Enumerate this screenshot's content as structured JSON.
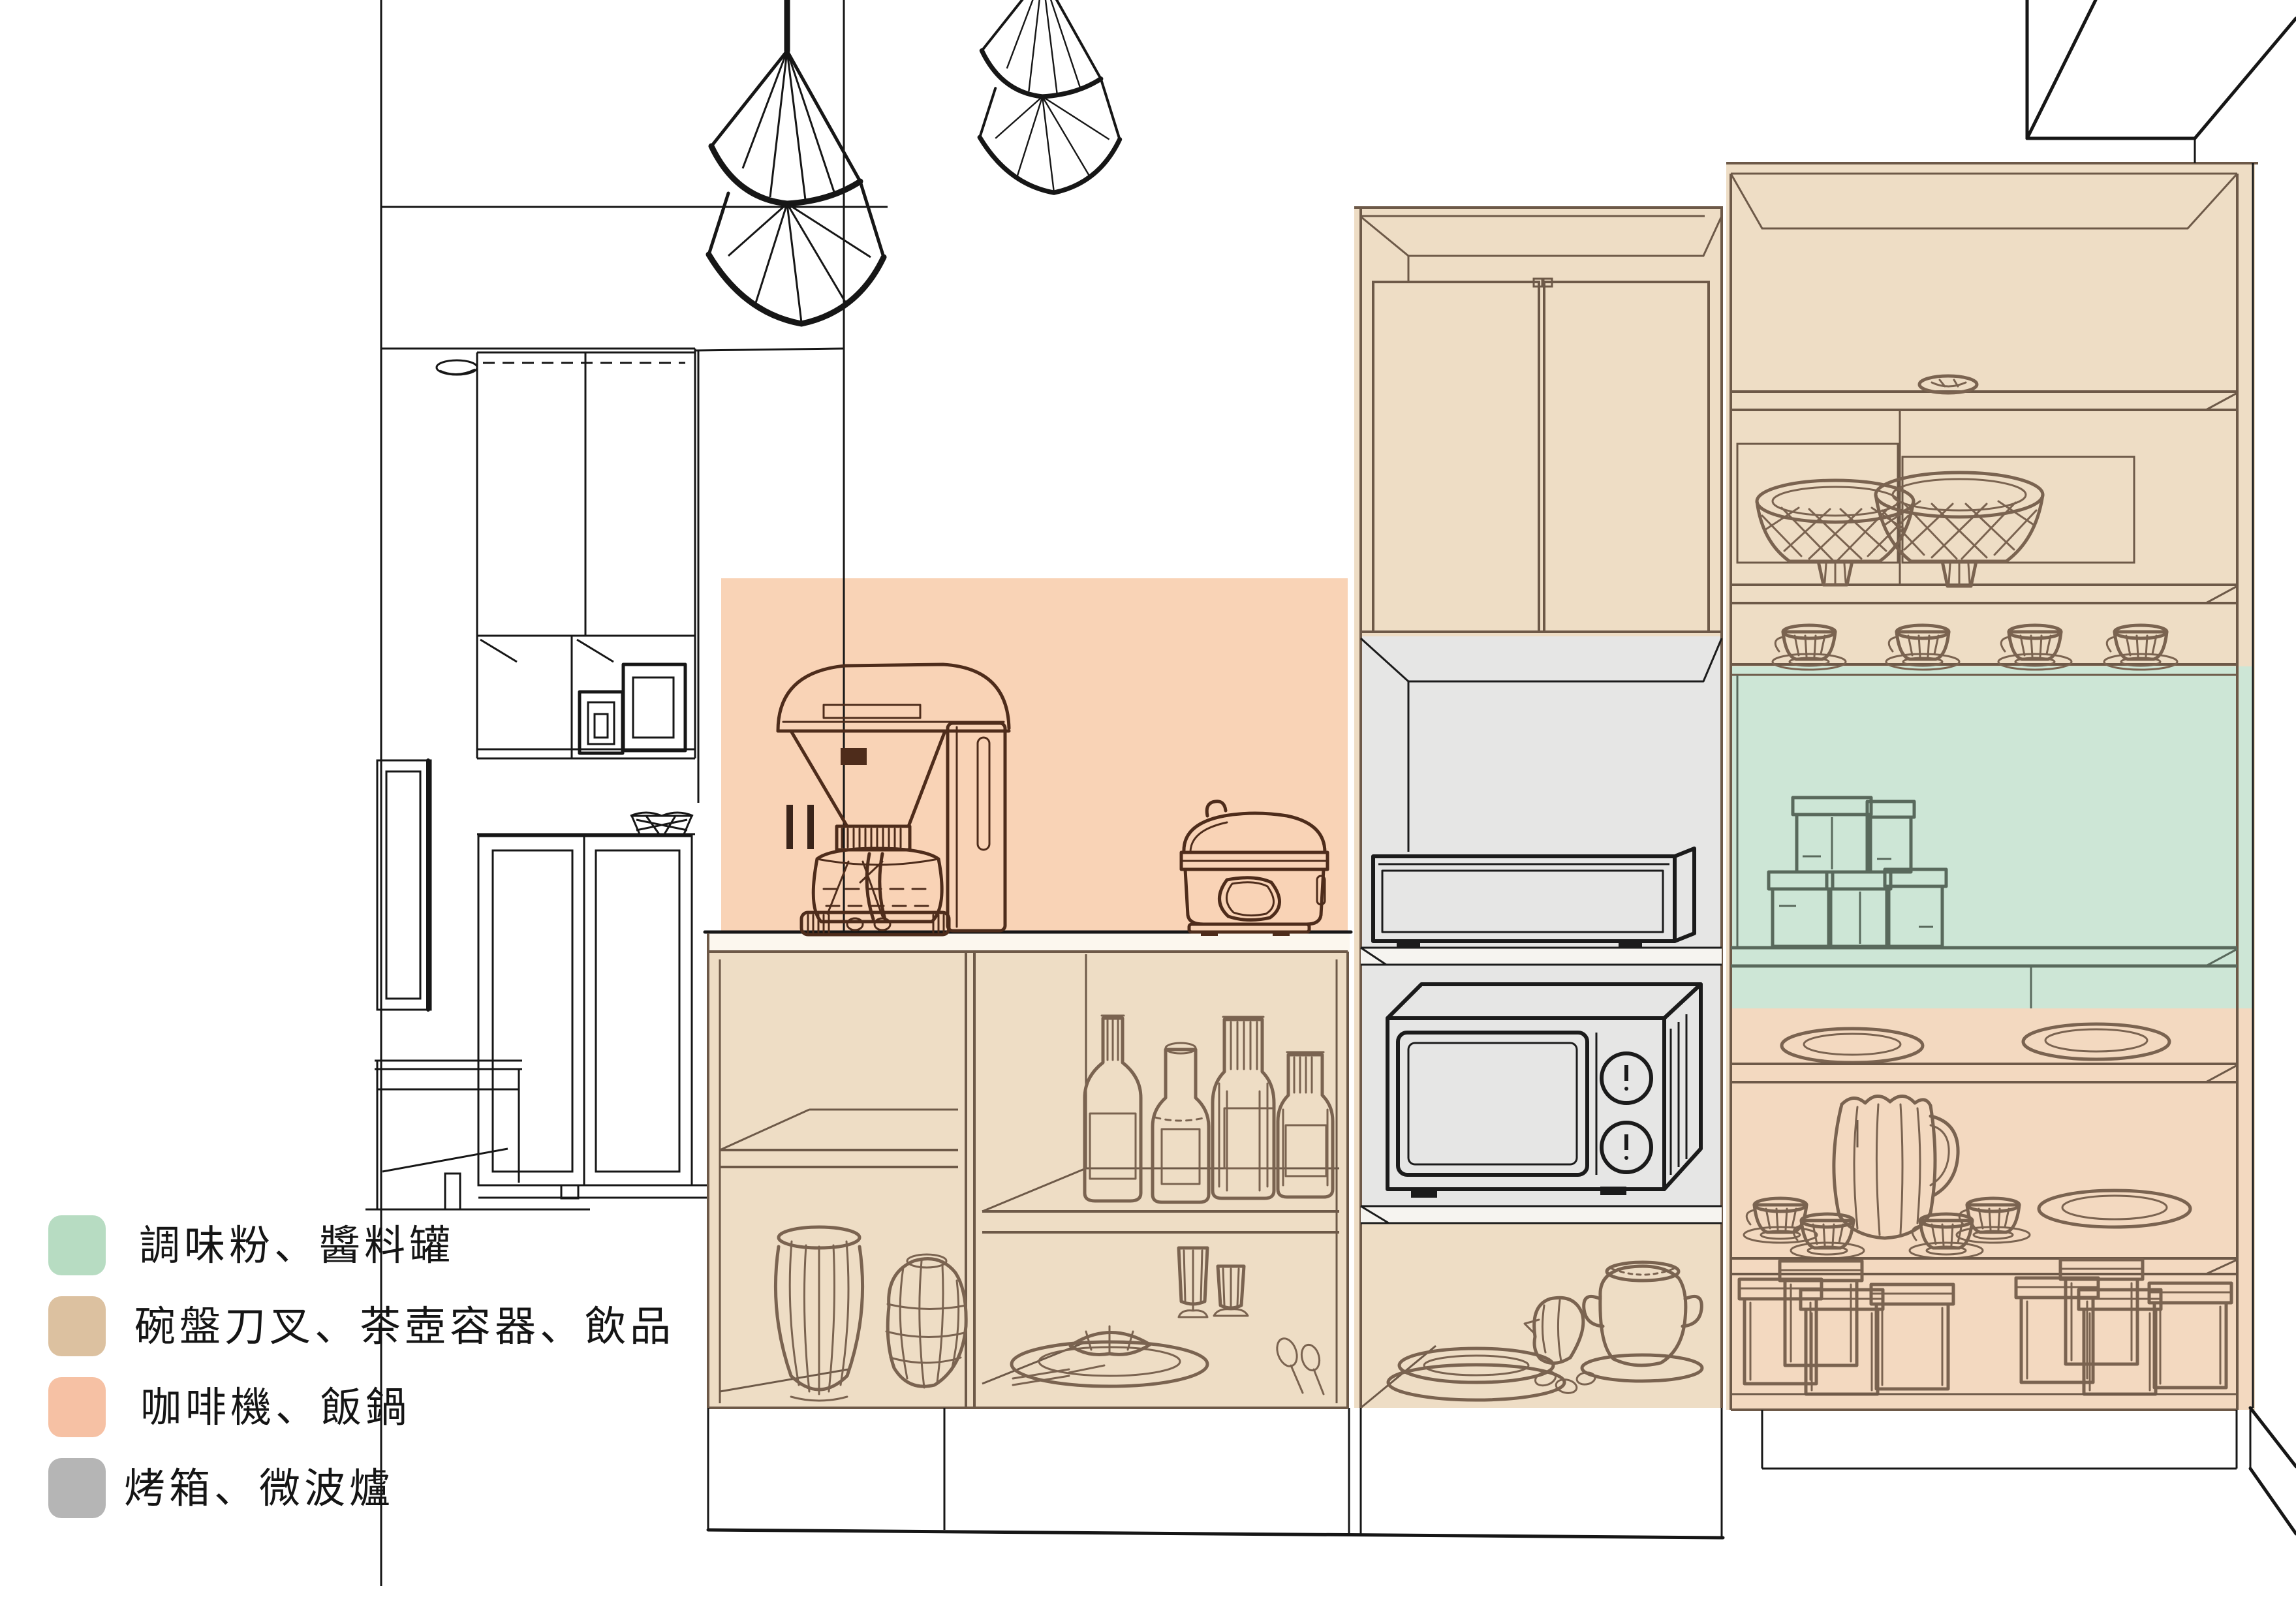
{
  "legend": {
    "items": [
      {
        "id": "seasoning",
        "label": "調味粉、醬料罐",
        "color": "#b7dcc2"
      },
      {
        "id": "dishes",
        "label": "碗盤刀叉、茶壺容器、飲品",
        "color": "#dcc1a0"
      },
      {
        "id": "coffee-rice",
        "label": "咖啡機、飯鍋",
        "color": "#f6c1a4"
      },
      {
        "id": "oven-microwave",
        "label": "烤箱、微波爐",
        "color": "#b5b5b5"
      }
    ]
  },
  "colors": {
    "zone_green": "#cde6d6",
    "zone_tan": "#eeddc5",
    "zone_tan_warm": "#f3d9c0",
    "zone_peach": "#f9d3b6",
    "zone_gray": "#e6e6e5",
    "counter": "#fcf7ee",
    "appliance_fill": "#f2f2f1",
    "shelf_fill": "#f6f4f0"
  }
}
